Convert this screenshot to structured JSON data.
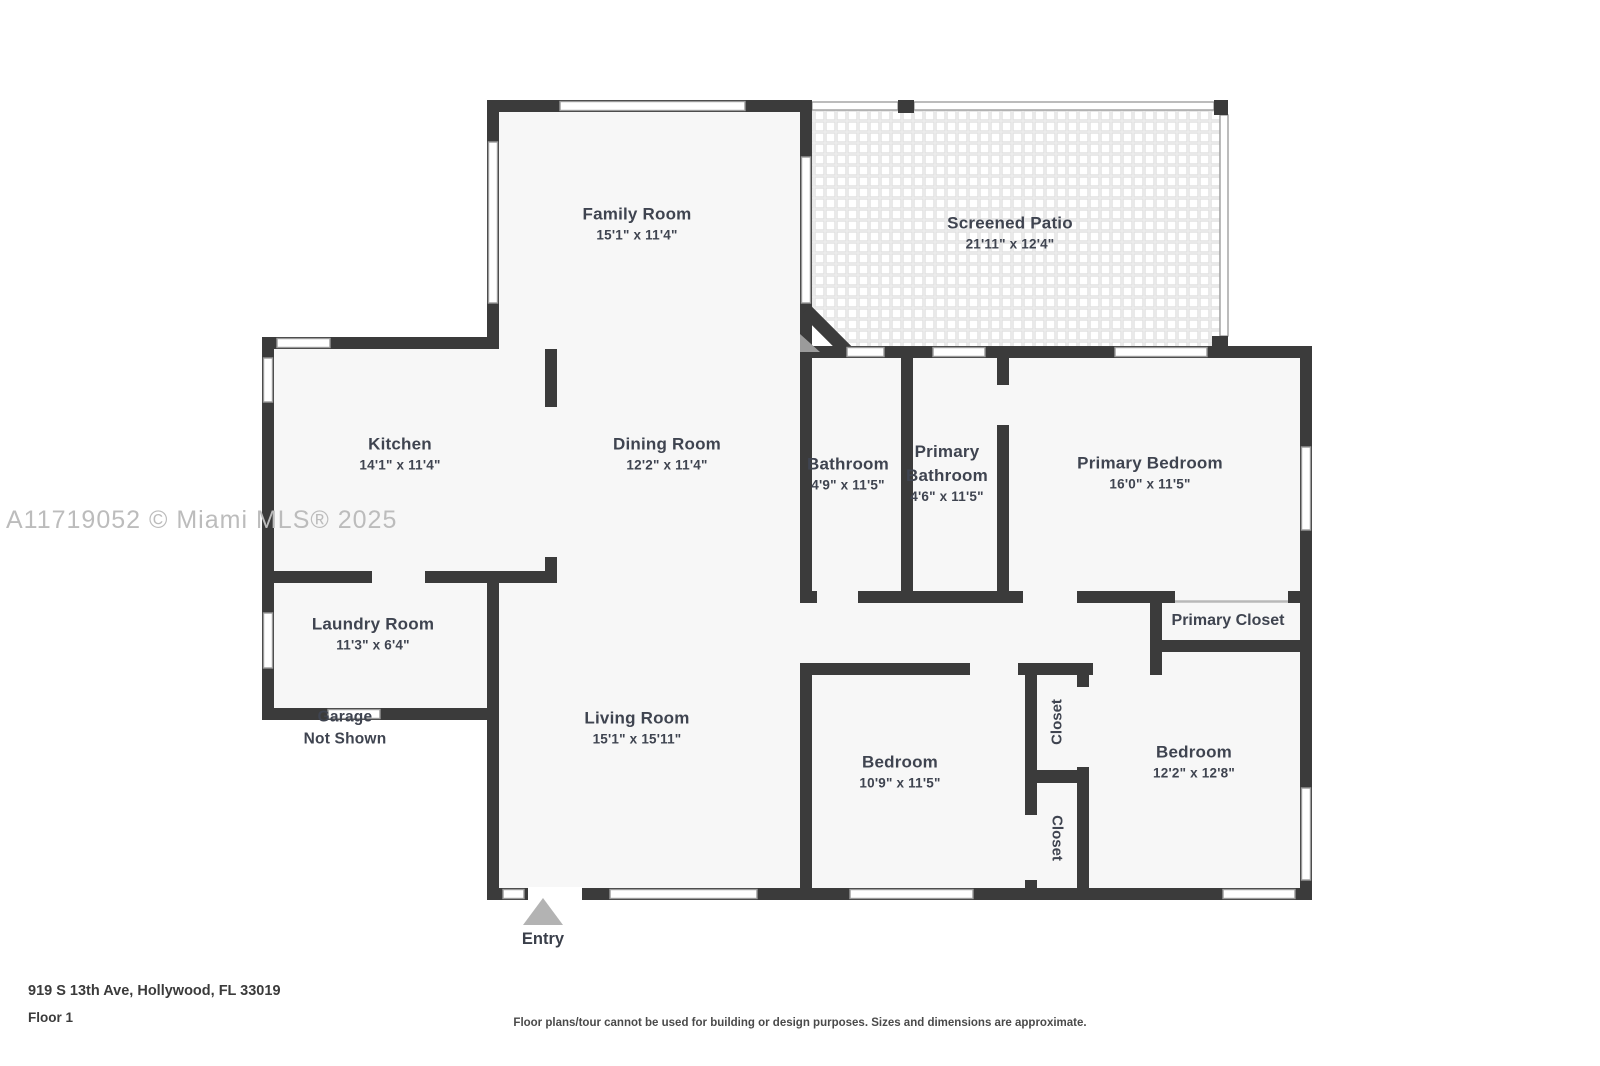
{
  "watermark": "A11719052 © Miami MLS® 2025",
  "entry": {
    "label": "Entry"
  },
  "garage": {
    "line1": "Garage",
    "line2": "Not Shown"
  },
  "rooms": {
    "family": {
      "name": "Family Room",
      "dims": "15'1\" x 11'4\""
    },
    "patio": {
      "name": "Screened Patio",
      "dims": "21'11\" x 12'4\""
    },
    "kitchen": {
      "name": "Kitchen",
      "dims": "14'1\" x 11'4\""
    },
    "dining": {
      "name": "Dining Room",
      "dims": "12'2\" x 11'4\""
    },
    "bathroom": {
      "name": "Bathroom",
      "dims": "4'9\" x 11'5\""
    },
    "primary_bathroom": {
      "name1": "Primary",
      "name2": "Bathroom",
      "dims": "4'6\" x 11'5\""
    },
    "primary_bedroom": {
      "name": "Primary Bedroom",
      "dims": "16'0\" x 11'5\""
    },
    "primary_closet": {
      "name": "Primary Closet"
    },
    "laundry": {
      "name": "Laundry Room",
      "dims": "11'3\" x 6'4\""
    },
    "living": {
      "name": "Living Room",
      "dims": "15'1\" x 15'11\""
    },
    "bedroom1": {
      "name": "Bedroom",
      "dims": "10'9\" x 11'5\""
    },
    "bedroom2": {
      "name": "Bedroom",
      "dims": "12'2\" x 12'8\""
    },
    "closet_top": {
      "name": "Closet"
    },
    "closet_bottom": {
      "name": "Closet"
    }
  },
  "footer": {
    "address": "919 S 13th Ave, Hollywood, FL 33019",
    "floor": "Floor 1",
    "disclaimer": "Floor plans/tour cannot be used for building or design purposes. Sizes and dimensions are approximate."
  },
  "colors": {
    "wall": "#3b3b3b",
    "floor": "#f7f7f7",
    "label": "#3f4450",
    "watermark": "#bcbcbc",
    "entry_marker": "#b3b3b3"
  }
}
